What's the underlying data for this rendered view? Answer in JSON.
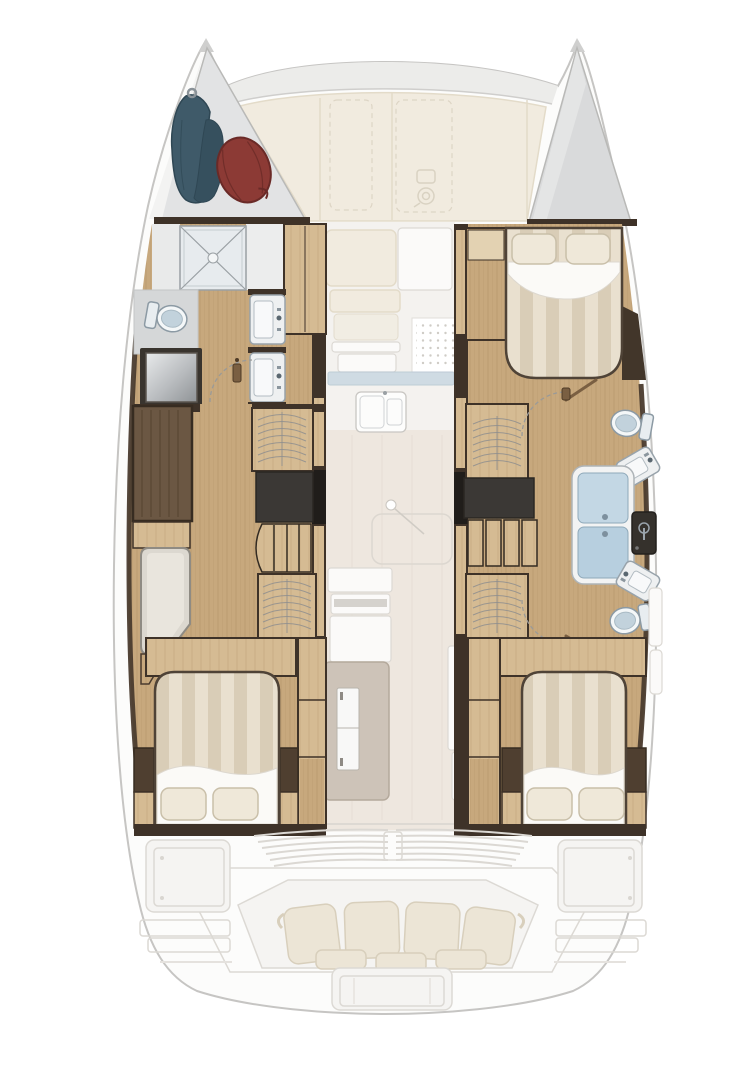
{
  "vessel": {
    "type": "sailing-catamaran",
    "view": "interior-deck-plan",
    "hulls": 2,
    "cabins": 3,
    "heads": 3
  },
  "palette": {
    "page_bg": "#ffffff",
    "hull_fill": "#fcfcfb",
    "hull_stroke": "#c6c5c3",
    "beam_grey": "#ececea",
    "deck_cream": "#f1ebdf",
    "deck_cream_stroke": "#e3dbc9",
    "forepeak_grey": "#d9dadb",
    "locker_grey": "#e2e3e4",
    "faded_fill": "#f5f4f2",
    "faded_stroke": "#dcd9d4",
    "cushion": "#ece5d6",
    "cushion_stroke": "#d8cfbc",
    "wood_floor": "#c7a87d",
    "wood_grain": "#ae8d62",
    "wood_light": "#d5bb93",
    "wood_pale": "#e4d3b2",
    "dark_wall": "#3e3228",
    "dark_brown": "#5a4836",
    "black_unit": "#35312c",
    "grey_floor": "#d5d7d8",
    "metal_hi": "#e8eaeb",
    "metal_lo": "#8f9396",
    "white_fixture": "#f2f3f4",
    "fixture_stroke": "#98a3ab",
    "toilet_inner": "#c2d2dc",
    "shower_glass_top": "#c3d7e4",
    "shower_glass_bottom": "#b7cfdf",
    "marble": "#eef0f1",
    "duvet_a": "#e9e0cf",
    "duvet_b": "#d9cdb7",
    "sheet": "#fbfaf7",
    "pillow": "#efe8d9",
    "pillow_stroke": "#c9bfa9",
    "sail_teal": "#3f5a69",
    "sail_teal_dark": "#2f4754",
    "fender_red": "#8c3a35",
    "fender_dark": "#6a2a27",
    "arc_grey": "#9a9a98",
    "door_wood": "#7a5f42",
    "dot_grey": "#cfccc6",
    "rail_grey": "#8e8e8e",
    "walkway": "#ece5dc"
  },
  "areas": [
    {
      "id": "foredeck",
      "fixtures": [
        "crossbeam",
        "deck-panels",
        "hatch-outline",
        "hatch-outline",
        "windlass"
      ]
    },
    {
      "id": "port-forepeak",
      "fixtures": [
        "sail-bag",
        "fender",
        "deck-hatch-x"
      ]
    },
    {
      "id": "port-bathroom",
      "fixtures": [
        "toilet",
        "shower-tray",
        "vanity-sink",
        "vanity-sink",
        "door-swing"
      ]
    },
    {
      "id": "port-dressing-room",
      "fixtures": [
        "wardrobe",
        "hanging-locker",
        "companionway-stairs",
        "hanging-locker",
        "lounge-seat"
      ]
    },
    {
      "id": "port-aft-cabin",
      "fixtures": [
        "double-bed",
        "pillow",
        "pillow",
        "nightstand",
        "nightstand",
        "cupboard-column"
      ]
    },
    {
      "id": "starboard-forepeak",
      "fixtures": []
    },
    {
      "id": "starboard-forward-cabin",
      "fixtures": [
        "double-bed",
        "pillow",
        "pillow",
        "wardrobe",
        "hanging-locker"
      ]
    },
    {
      "id": "starboard-forward-head",
      "fixtures": [
        "toilet",
        "vanity-sink",
        "door-swing"
      ]
    },
    {
      "id": "starboard-shower-room",
      "fixtures": [
        "shower-stall",
        "tech-locker",
        "companionway-stairs"
      ]
    },
    {
      "id": "starboard-aft-head",
      "fixtures": [
        "toilet",
        "vanity-sink",
        "door-swing"
      ]
    },
    {
      "id": "starboard-aft-cabin",
      "fixtures": [
        "double-bed",
        "pillow",
        "pillow",
        "nightstand",
        "nightstand",
        "cupboard-column"
      ]
    },
    {
      "id": "salon",
      "fixtures": [
        "forward-seat",
        "chart-seat",
        "stove-grate",
        "counter-edge",
        "double-sink",
        "dining-table",
        "aft-counter",
        "fridge",
        "shelf-unit"
      ]
    },
    {
      "id": "cockpit",
      "fixtures": [
        "louver-grille",
        "helm-console",
        "helm-console",
        "bench-cushions",
        "seat-pads",
        "transom-platform"
      ]
    }
  ]
}
